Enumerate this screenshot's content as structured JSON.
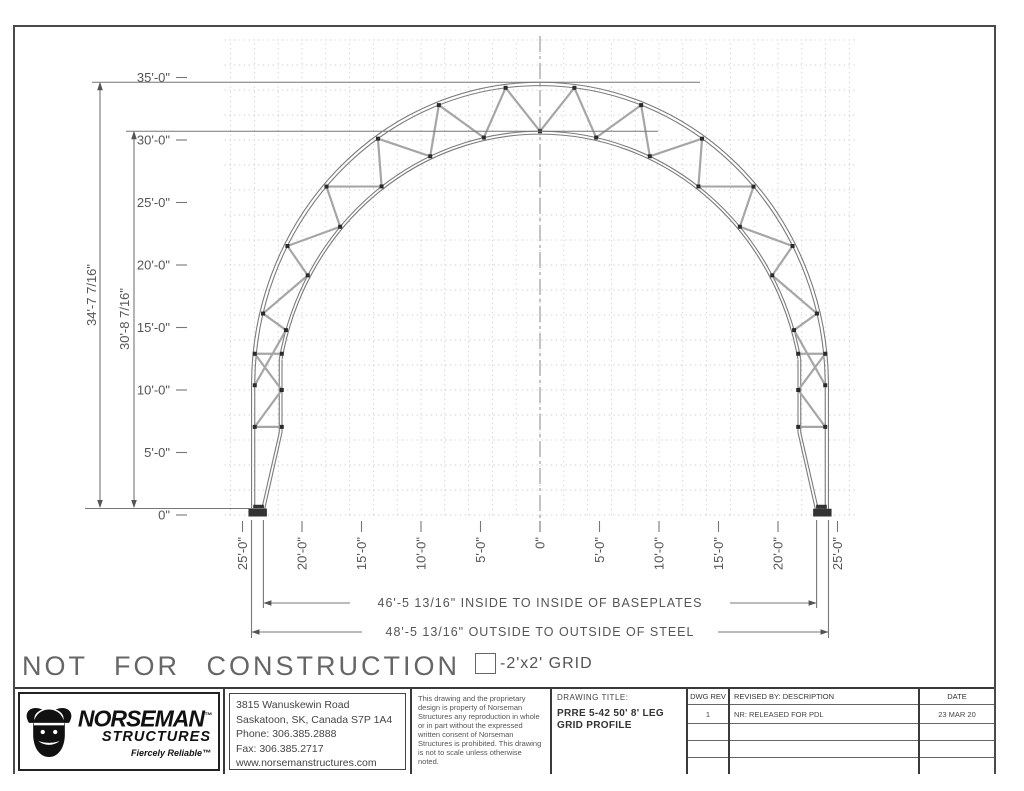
{
  "page": {
    "not_for_construction": "NOT FOR CONSTRUCTION",
    "grid_legend": "-2'x2' GRID"
  },
  "drawing": {
    "y_ticks": [
      {
        "label": "35'-0\"",
        "ft": 35
      },
      {
        "label": "30'-0\"",
        "ft": 30
      },
      {
        "label": "25'-0\"",
        "ft": 25
      },
      {
        "label": "20'-0\"",
        "ft": 20
      },
      {
        "label": "15'-0\"",
        "ft": 15
      },
      {
        "label": "10'-0\"",
        "ft": 10
      },
      {
        "label": "5'-0\"",
        "ft": 5
      },
      {
        "label": "0\"",
        "ft": 0
      }
    ],
    "x_ticks": [
      {
        "label": "25'-0\"",
        "ft": -25
      },
      {
        "label": "20'-0\"",
        "ft": -20
      },
      {
        "label": "15'-0\"",
        "ft": -15
      },
      {
        "label": "10'-0\"",
        "ft": -10
      },
      {
        "label": "5'-0\"",
        "ft": -5
      },
      {
        "label": "0\"",
        "ft": 0
      },
      {
        "label": "5'-0\"",
        "ft": 5
      },
      {
        "label": "10'-0\"",
        "ft": 10
      },
      {
        "label": "15'-0\"",
        "ft": 15
      },
      {
        "label": "20'-0\"",
        "ft": 20
      },
      {
        "label": "25'-0\"",
        "ft": 25
      }
    ],
    "dim_outer_height": "34'-7 7/16\"",
    "dim_inner_height": "30'-8 7/16\"",
    "dim_inside": "46'-5 13/16\" INSIDE TO INSIDE OF BASEPLATES",
    "dim_outside": "48'-5 13/16\" OUTSIDE TO OUTSIDE OF STEEL"
  },
  "title_block": {
    "logo": {
      "brand": "NORSEMAN",
      "brand_tm": "™",
      "sub": "STRUCTURES",
      "tagline": "Fiercely Reliable™"
    },
    "address": [
      "3815 Wanuskewin Road",
      "Saskatoon, SK, Canada S7P 1A4",
      "Phone: 306.385.2888",
      "Fax: 306.385.2717",
      "www.norsemanstructures.com"
    ],
    "disclaimer": "This drawing and the proprietary design is property of Norseman Structures any reproduction in whole or in part without the expressed written consent of Norseman Structures is prohibited. This drawing is not to scale unless otherwise noted.",
    "drawing_title_label": "DRAWING TITLE:",
    "drawing_title": "PRRE 5-42 50' 8' LEG",
    "drawing_title_line2": "GRID PROFILE",
    "rev_headers": {
      "dwg_rev": "DWG REV",
      "revised_by": "REVISED BY: DESCRIPTION",
      "date": "DATE"
    },
    "rev_rows": [
      {
        "rev": "1",
        "description": "NR: RELEASED FOR PDL",
        "date": "23 MAR 20"
      },
      {
        "rev": "",
        "description": "",
        "date": ""
      },
      {
        "rev": "",
        "description": "",
        "date": ""
      },
      {
        "rev": "",
        "description": "",
        "date": ""
      }
    ]
  }
}
